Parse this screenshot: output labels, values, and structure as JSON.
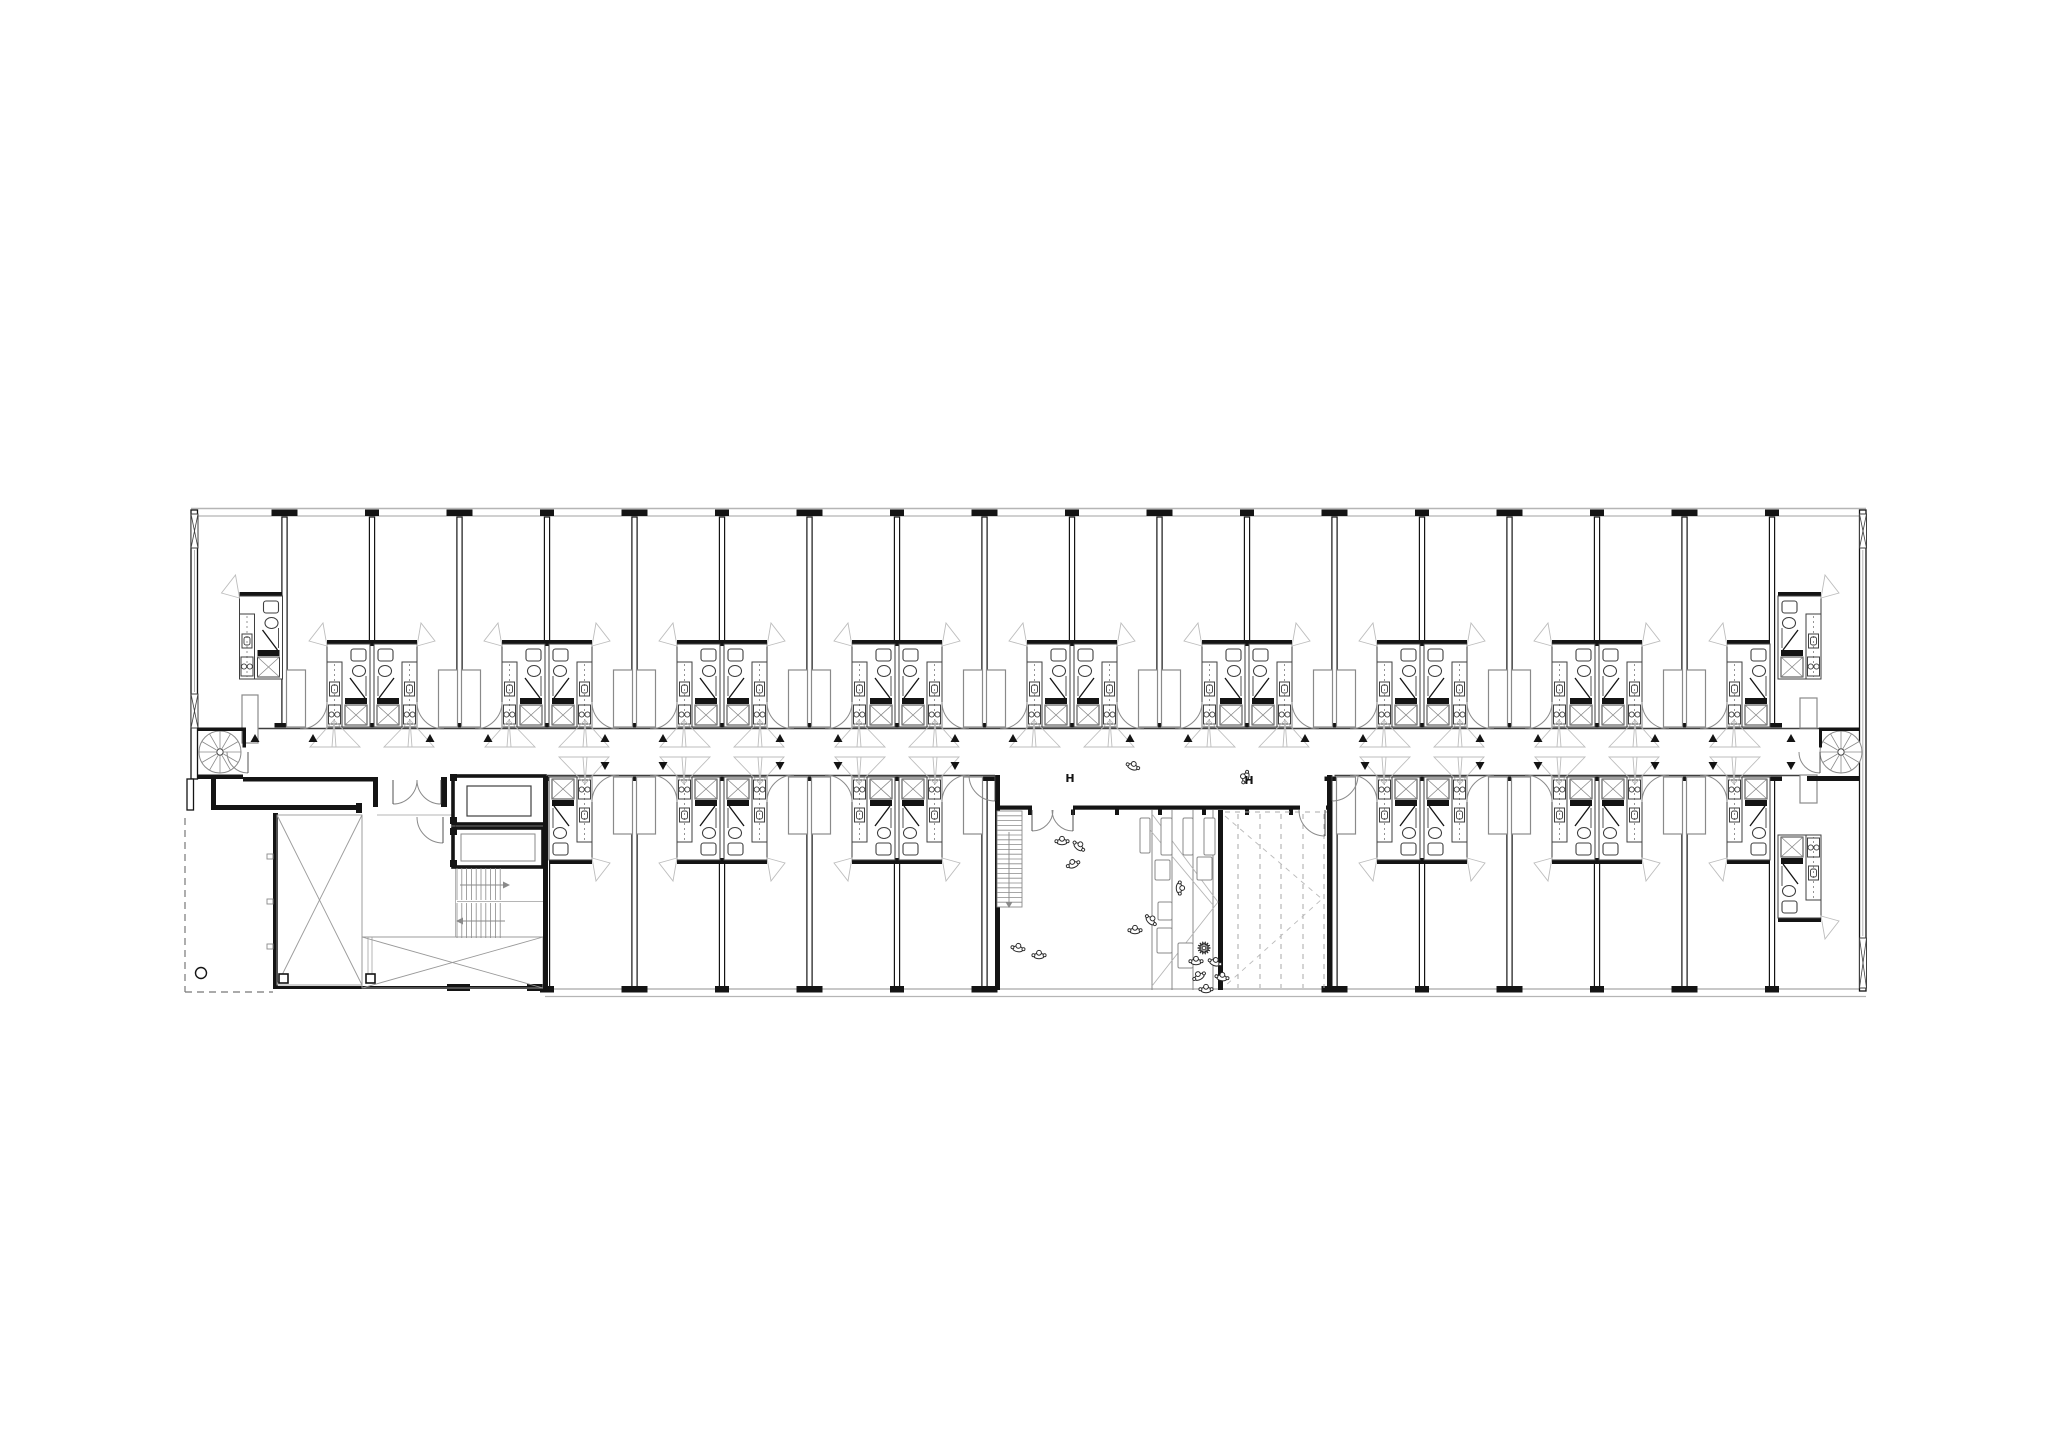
{
  "labels": {
    "h1": "H",
    "h2": "H"
  },
  "colors": {
    "ink": "#141414",
    "mid": "#3f3f3f",
    "gray": "#8a8a8a",
    "light": "#b5b5b5",
    "fan": "#bdbdbd",
    "bg": "#ffffff"
  },
  "canvas": {
    "w": 2048,
    "h": 1448
  },
  "geometry": {
    "facade": {
      "x1": 191,
      "x2": 1866,
      "top_y": [
        508.5,
        516
      ],
      "bottom_y": [
        989,
        996.5
      ],
      "bottom_x1": 545
    },
    "side_walls": {
      "left": [
        191,
        510,
        6.5,
        269
      ],
      "left2": [
        187,
        779,
        6.5,
        31
      ],
      "right": [
        1859.5,
        510,
        6.5,
        481
      ]
    },
    "hatches": [
      [
        191,
        514,
        7,
        34
      ],
      [
        191,
        694,
        7,
        34
      ],
      [
        1859.5,
        514,
        7,
        34
      ],
      [
        1859.5,
        938,
        7,
        50
      ]
    ],
    "glaze_lines": [
      [
        194.5,
        550,
        194.5,
        692
      ],
      [
        1862.8,
        550,
        1862.8,
        936
      ]
    ],
    "corridor": {
      "top_y": 728.5,
      "top_x1": 197,
      "top_x2": 1859,
      "bot_y": 775.5,
      "bot_segs": [
        [
          547,
          995
        ],
        [
          1334.5,
          1807
        ]
      ]
    },
    "walls_top": {
      "y1": 517,
      "y2": 726,
      "items": [
        [
          284.5,
          "W"
        ],
        [
          372,
          "P"
        ],
        [
          459.5,
          "W"
        ],
        [
          547,
          "P"
        ],
        [
          634.5,
          "W"
        ],
        [
          722,
          "P"
        ],
        [
          809.5,
          "W"
        ],
        [
          897,
          "P"
        ],
        [
          984.5,
          "W"
        ],
        [
          1072,
          "P"
        ],
        [
          1159.5,
          "W"
        ],
        [
          1247,
          "P"
        ],
        [
          1334.5,
          "W"
        ],
        [
          1422,
          "P"
        ],
        [
          1509.5,
          "W"
        ],
        [
          1597,
          "P"
        ],
        [
          1684.5,
          "W"
        ],
        [
          1772,
          "P"
        ]
      ]
    },
    "walls_bottom": {
      "y1": 778,
      "y2": 987,
      "items": [
        [
          547,
          "P"
        ],
        [
          634.5,
          "W"
        ],
        [
          722,
          "P"
        ],
        [
          809.5,
          "W"
        ],
        [
          897,
          "P"
        ],
        [
          984.5,
          "W"
        ],
        [
          1334.5,
          "W"
        ],
        [
          1422,
          "P"
        ],
        [
          1509.5,
          "W"
        ],
        [
          1597,
          "P"
        ],
        [
          1684.5,
          "W"
        ],
        [
          1772,
          "P"
        ]
      ]
    },
    "pods_top": [
      [
        372,
        "both"
      ],
      [
        547,
        "both"
      ],
      [
        722,
        "both"
      ],
      [
        897,
        "both"
      ],
      [
        1072,
        "both"
      ],
      [
        1247,
        "both"
      ],
      [
        1422,
        "both"
      ],
      [
        1597,
        "both"
      ],
      [
        1772,
        "left"
      ]
    ],
    "pods_bottom": [
      [
        547,
        "right"
      ],
      [
        722,
        "both"
      ],
      [
        897,
        "both"
      ],
      [
        1422,
        "both"
      ],
      [
        1597,
        "both"
      ],
      [
        1772,
        "left"
      ]
    ],
    "wardrobes_top": [
      [
        284.5,
        "right"
      ],
      [
        459.5,
        "both"
      ],
      [
        634.5,
        "both"
      ],
      [
        809.5,
        "both"
      ],
      [
        984.5,
        "both"
      ],
      [
        1159.5,
        "both"
      ],
      [
        1334.5,
        "both"
      ],
      [
        1509.5,
        "both"
      ],
      [
        1684.5,
        "both"
      ]
    ],
    "wardrobes_bottom": [
      [
        634.5,
        "both"
      ],
      [
        809.5,
        "both"
      ],
      [
        984.5,
        "left"
      ],
      [
        1334.5,
        "right"
      ],
      [
        1509.5,
        "both"
      ],
      [
        1684.5,
        "both"
      ]
    ],
    "special_pods": [
      {
        "wall": 284.5,
        "side": -1,
        "row": "top"
      },
      {
        "wall": 1776,
        "side": 1,
        "row": "top"
      },
      {
        "wall": 1776,
        "side": 1,
        "row": "bottom"
      }
    ],
    "special_wardrobes": [
      [
        242,
        695,
        16,
        48
      ],
      [
        1800,
        698,
        17,
        30
      ],
      [
        1800,
        775,
        17,
        28
      ]
    ],
    "tri_up": {
      "y": 734,
      "xs": [
        255,
        313,
        430,
        488,
        605,
        663,
        780,
        838,
        955,
        1013,
        1130,
        1188,
        1305,
        1363,
        1480,
        1538,
        1655,
        1713,
        1791
      ]
    },
    "tri_down": {
      "y": 762,
      "xs": [
        605,
        663,
        780,
        838,
        955,
        1365,
        1480,
        1538,
        1655,
        1713,
        1791
      ]
    },
    "spirals": [
      {
        "cx": 220,
        "cy": 752,
        "r": 21
      },
      {
        "cx": 1841,
        "cy": 752,
        "r": 21
      }
    ],
    "vestibule_walls": [
      [
        197,
        727.5,
        49,
        3.5
      ],
      [
        197,
        774.5,
        46,
        4.5
      ],
      [
        242.5,
        727.5,
        3.5,
        20
      ],
      [
        1822,
        727.5,
        37.5,
        3.5
      ],
      [
        1807,
        776,
        52.5,
        5
      ],
      [
        1819,
        727.5,
        3,
        20
      ]
    ],
    "left_zone": {
      "heavy": [
        [
          212,
          805,
          150,
          5
        ],
        [
          211,
          777,
          5,
          33
        ],
        [
          243,
          777,
          134,
          4.5
        ],
        [
          373,
          777,
          5,
          30
        ],
        [
          441,
          777,
          6,
          30
        ],
        [
          356,
          803,
          6,
          10
        ],
        [
          273,
          813,
          5,
          175
        ],
        [
          273,
          986,
          274,
          3
        ],
        [
          447,
          984,
          23,
          7
        ],
        [
          527,
          984,
          20,
          7
        ]
      ],
      "gray_lines": [
        [
          362,
          815,
          362,
          985
        ],
        [
          362,
          937,
          543,
          937
        ],
        [
          377,
          815,
          457,
          815
        ],
        [
          368,
          937,
          368,
          975
        ],
        [
          372,
          937,
          372,
          975
        ],
        [
          455.5,
          776,
          455.5,
          937
        ]
      ],
      "dashed": [
        [
          185,
          818,
          185,
          992
        ],
        [
          185,
          992,
          273,
          992
        ]
      ],
      "dash_circle": [
        201,
        973,
        5.5
      ],
      "voids": [
        [
          277,
          815,
          85,
          170
        ],
        [
          362,
          937,
          181,
          51
        ]
      ],
      "wall_ticks": [
        [
          267,
          854,
          6,
          5
        ],
        [
          267,
          899,
          6,
          5
        ],
        [
          267,
          944,
          6,
          5
        ]
      ],
      "cols": [
        [
          279,
          974,
          9,
          9
        ],
        [
          366,
          974,
          9,
          9
        ]
      ]
    },
    "core": {
      "shaft1": [
        453,
        776,
        92,
        48
      ],
      "shaft1_in": [
        467,
        786,
        64,
        30
      ],
      "shaft2": [
        453,
        828,
        90,
        39
      ],
      "shaft2_in": [
        461,
        834,
        74,
        27
      ],
      "nubs": [
        [
          450,
          774,
          7,
          7
        ],
        [
          450,
          817,
          7,
          7
        ],
        [
          450,
          828,
          7,
          7
        ],
        [
          450,
          860,
          7,
          7
        ]
      ],
      "stair": {
        "x1": 457,
        "x2": 505,
        "y1": 868,
        "midY": 901,
        "y2": 938,
        "landX": 543
      },
      "right_wall": [
        543,
        776,
        5,
        214
      ]
    },
    "common": {
      "wall_segs": [
        [
          995,
          1032
        ],
        [
          1073,
          1300
        ],
        [
          1326,
          1332
        ]
      ],
      "wall_y": 805.5,
      "ticks": [
        1030,
        1073,
        1117,
        1160,
        1204,
        1247,
        1291
      ],
      "left_wall": [
        995,
        775,
        5,
        215
      ],
      "right_wall": [
        1327,
        775,
        5,
        215
      ],
      "seat_wall": [
        1218,
        810,
        5,
        180
      ],
      "stair": {
        "x": 997,
        "y": 811,
        "w": 25,
        "h": 96,
        "steps": 20
      },
      "seat_lines": [
        1152,
        1172,
        1193,
        1213
      ],
      "seat_diag": [
        [
          1152,
          814,
          1218,
          902
        ],
        [
          1152,
          986,
          1218,
          902
        ],
        [
          1140,
          818,
          1213,
          905
        ]
      ],
      "deck_dash_x": [
        1238,
        1260,
        1281,
        1303,
        1324
      ],
      "deck_top": [
        1225,
        812,
        1327,
        812
      ],
      "chevron": [
        [
          1225,
          816
        ],
        [
          1322,
          899
        ],
        [
          1225,
          986
        ]
      ],
      "cushions": [
        [
          1140,
          818,
          10,
          35
        ],
        [
          1161,
          818,
          11,
          37
        ],
        [
          1183,
          818,
          10,
          37
        ],
        [
          1204,
          818,
          11,
          37
        ],
        [
          1155,
          860,
          15,
          20
        ],
        [
          1197,
          857,
          15,
          23
        ],
        [
          1157,
          928,
          15,
          25
        ],
        [
          1178,
          943,
          15,
          25
        ],
        [
          1158,
          902,
          14,
          18
        ]
      ]
    },
    "doors": [
      [
        [
          248,
          752
        ],
        [
          227,
          752
        ],
        [
          248,
          773
        ]
      ],
      [
        [
          393,
          780
        ],
        [
          417,
          780
        ],
        [
          393,
          804
        ]
      ],
      [
        [
          441,
          780
        ],
        [
          417,
          780
        ],
        [
          441,
          804
        ]
      ],
      [
        [
          443,
          817
        ],
        [
          417,
          817
        ],
        [
          443,
          843
        ]
      ],
      [
        [
          1032,
          810
        ],
        [
          1053,
          810
        ],
        [
          1032,
          831
        ]
      ],
      [
        [
          1073,
          810
        ],
        [
          1052,
          810
        ],
        [
          1073,
          831
        ]
      ],
      [
        [
          1325,
          810
        ],
        [
          1299,
          810
        ],
        [
          1325,
          836
        ]
      ],
      [
        [
          1820,
          752
        ],
        [
          1799,
          752
        ],
        [
          1820,
          773
        ]
      ],
      [
        [
          995,
          775
        ],
        [
          969,
          775
        ],
        [
          995,
          801
        ]
      ],
      [
        [
          1332,
          775
        ],
        [
          1358,
          775
        ],
        [
          1332,
          801
        ]
      ]
    ],
    "people": [
      [
        1133,
        766,
        20
      ],
      [
        1245,
        777,
        -70
      ],
      [
        1062,
        841,
        0
      ],
      [
        1079,
        846,
        40
      ],
      [
        1073,
        864,
        -20
      ],
      [
        1018,
        948,
        10
      ],
      [
        1039,
        955,
        0
      ],
      [
        1180,
        888,
        90
      ],
      [
        1151,
        920,
        45
      ],
      [
        1135,
        930,
        0
      ],
      [
        1196,
        961,
        0
      ],
      [
        1215,
        962,
        20
      ],
      [
        1199,
        976,
        -30
      ],
      [
        1222,
        977,
        10
      ],
      [
        1206,
        989,
        0
      ]
    ],
    "plant": [
      1204,
      948
    ],
    "h_labels": [
      [
        1070,
        782
      ],
      [
        1249,
        784
      ]
    ]
  }
}
